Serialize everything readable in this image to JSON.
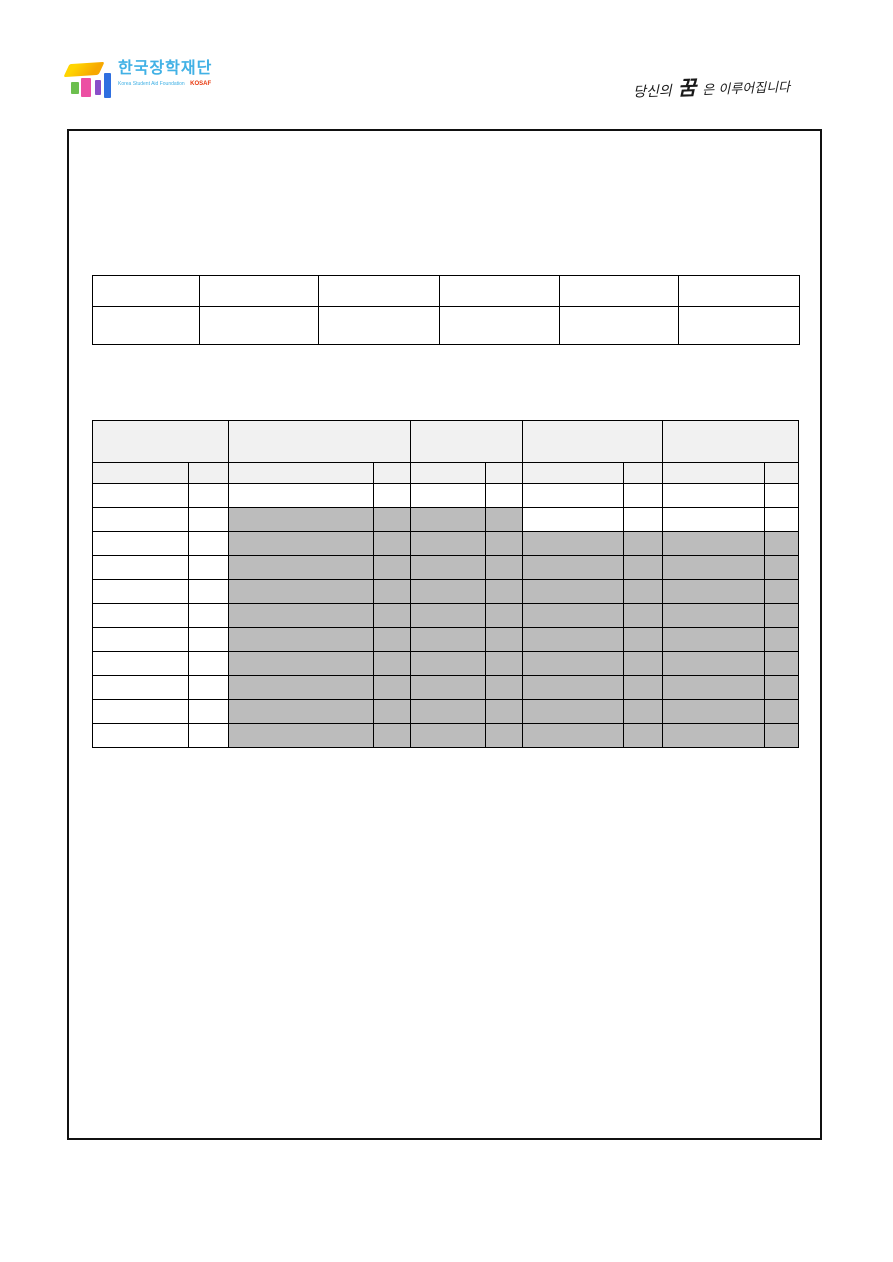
{
  "header": {
    "logo": {
      "title": "한국장학재단",
      "subtitle": "Korea Student Aid Foundation",
      "acronym": "KOSAF",
      "colors": {
        "title_blue": "#41b1e5",
        "acronym_red": "#e8380d",
        "cap_orange": "#f7a800",
        "cap_yellow": "#ffd400",
        "block_green": "#6cbf4e",
        "block_pink": "#ec4fa3",
        "block_purple": "#8a4fc9",
        "block_blue": "#2f6fe0"
      }
    },
    "slogan": {
      "part1": "당신의",
      "part2": "꿈",
      "part3": "은 이루어집니다"
    }
  },
  "document_box": {
    "border_color": "#111111",
    "content": ""
  },
  "table1": {
    "description": "empty 6-column, 2-row form table; all cells blank",
    "header_bg": "#f1f1f1",
    "shade_color": "#bcbcbc",
    "col_widths": [
      107,
      119,
      121,
      120,
      119,
      121
    ],
    "rows": [
      {
        "height": 31,
        "cells": [
          "w",
          "w",
          "w",
          "w",
          "w",
          "w"
        ]
      },
      {
        "height": 38,
        "cells": [
          "w",
          "w",
          "w",
          "w",
          "w",
          "w"
        ]
      }
    ]
  },
  "table2": {
    "description": "empty schedule-style table; light-gray header rows, gray shaded blocked-out cells, no visible text",
    "header_bg": "#f1f1f1",
    "shade_color": "#bcbcbc",
    "col_widths": [
      96,
      40,
      145,
      37,
      75,
      37,
      101,
      39,
      102,
      34
    ],
    "rows": [
      {
        "height": 42,
        "cells": [
          "h2",
          "h2",
          "h2",
          "h2",
          "h2"
        ]
      },
      {
        "height": 21,
        "cells": [
          "h",
          "h",
          "h",
          "h",
          "h",
          "h",
          "h",
          "h",
          "h",
          "h"
        ]
      },
      {
        "height": 24,
        "cells": [
          "w",
          "w",
          "w",
          "w",
          "w",
          "w",
          "w",
          "w",
          "w",
          "w"
        ]
      },
      {
        "height": 24,
        "cells": [
          "w",
          "w",
          "s",
          "s",
          "s",
          "s",
          "w",
          "w",
          "w",
          "w"
        ]
      },
      {
        "height": 24,
        "cells": [
          "w",
          "w",
          "s",
          "s",
          "s",
          "s",
          "s",
          "s",
          "s",
          "s"
        ]
      },
      {
        "height": 24,
        "cells": [
          "w",
          "w",
          "s",
          "s",
          "s",
          "s",
          "s",
          "s",
          "s",
          "s"
        ]
      },
      {
        "height": 24,
        "cells": [
          "w",
          "w",
          "s",
          "s",
          "s",
          "s",
          "s",
          "s",
          "s",
          "s"
        ]
      },
      {
        "height": 24,
        "cells": [
          "w",
          "w",
          "s",
          "s",
          "s",
          "s",
          "s",
          "s",
          "s",
          "s"
        ]
      },
      {
        "height": 24,
        "cells": [
          "w",
          "w",
          "s",
          "s",
          "s",
          "s",
          "s",
          "s",
          "s",
          "s"
        ]
      },
      {
        "height": 24,
        "cells": [
          "w",
          "w",
          "s",
          "s",
          "s",
          "s",
          "s",
          "s",
          "s",
          "s"
        ]
      },
      {
        "height": 24,
        "cells": [
          "w",
          "w",
          "s",
          "s",
          "s",
          "s",
          "s",
          "s",
          "s",
          "s"
        ]
      },
      {
        "height": 24,
        "cells": [
          "w",
          "w",
          "s",
          "s",
          "s",
          "s",
          "s",
          "s",
          "s",
          "s"
        ]
      },
      {
        "height": 24,
        "cells": [
          "w",
          "w",
          "s",
          "s",
          "s",
          "s",
          "s",
          "s",
          "s",
          "s"
        ]
      }
    ]
  }
}
